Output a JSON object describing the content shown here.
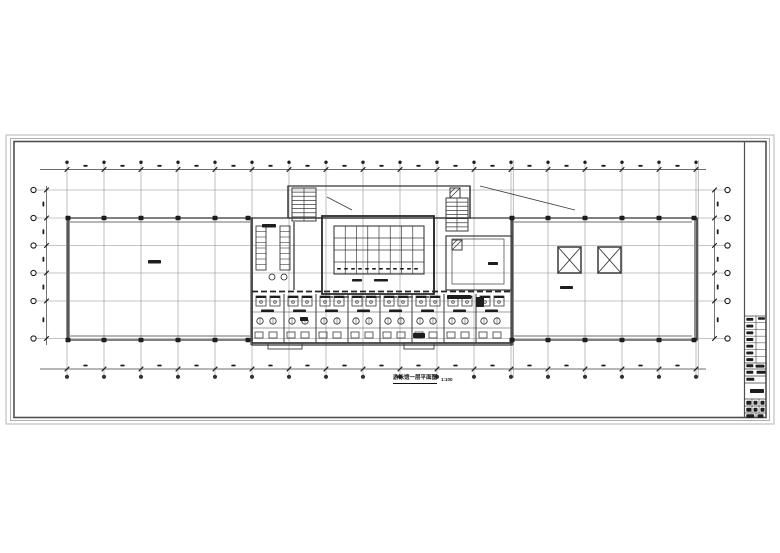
{
  "drawing": {
    "title": "游泳馆一层平面图",
    "scale": "1:100"
  },
  "colors": {
    "bg": "#ffffff",
    "line": "#3b3b3b",
    "dark": "#1d1d1d",
    "heavy": "#8f8f8f",
    "grid": "#8a8a8a",
    "frame_outer": "#b5b5b5",
    "frame_mid": "#9a9a9a",
    "frame_inner": "#4f4f4f"
  },
  "frame": {
    "outer": [
      6,
      135,
      768,
      289
    ],
    "mid": [
      10.5,
      138.5,
      759,
      282
    ],
    "inner": [
      14,
      141.5,
      752,
      276
    ],
    "divider_x": 744.5
  },
  "grid": {
    "verticals": {
      "x0": 67,
      "step": 37,
      "count": 18,
      "y1": 160,
      "y2": 378,
      "double_idx": [
        12,
        17
      ]
    },
    "horizontal_ys": [
      190,
      218,
      245.5,
      273,
      301,
      338.5
    ],
    "h_x1": 36,
    "h_x2": 726
  },
  "dims": {
    "top": {
      "y": 169.5,
      "x1": 40,
      "x2": 706,
      "bubble_y": 162.3
    },
    "bottom": {
      "y": 369,
      "x1": 40,
      "x2": 706,
      "bubble_y": 376.8
    },
    "left": {
      "x": 46.5,
      "y1": 186,
      "y2": 345,
      "bubble_x": 33.5,
      "text_x": 42.5
    },
    "right": {
      "x": 714.5,
      "y1": 190,
      "y2": 339,
      "bubble_x": 727.5,
      "text_x": 716.8
    }
  },
  "plan": {
    "outline_rects": [
      [
        68,
        218,
        184,
        122,
        1.3
      ],
      [
        512,
        218,
        185,
        122,
        1.3
      ],
      [
        288,
        186,
        182,
        32,
        1.3
      ],
      [
        252,
        218,
        260,
        127,
        1.3
      ],
      [
        446,
        236,
        66,
        54,
        1.2
      ],
      [
        452,
        239,
        52,
        45,
        0.7
      ],
      [
        268,
        343,
        34,
        6,
        0.9
      ],
      [
        404,
        343,
        30,
        6,
        0.9
      ]
    ],
    "inner_wall_lines": [
      [
        70,
        222,
        250,
        222,
        0.7
      ],
      [
        70,
        336,
        250,
        336,
        0.7
      ],
      [
        514,
        222,
        692,
        222,
        0.7
      ],
      [
        514,
        336,
        692,
        336,
        0.7
      ],
      [
        294,
        222,
        294,
        290,
        1.3
      ],
      [
        434,
        216,
        434,
        294,
        1.7
      ],
      [
        252,
        343,
        512,
        343,
        1.7
      ],
      [
        288,
        186,
        288,
        218,
        1.3
      ],
      [
        470,
        186,
        470,
        218,
        1.3
      ],
      [
        252,
        312,
        512,
        312,
        0.5
      ],
      [
        252,
        328,
        512,
        328,
        0.5
      ]
    ],
    "heavy_bars": [
      [
        66,
        218,
        4,
        122
      ],
      [
        694,
        218,
        4,
        122
      ],
      [
        510,
        218,
        4,
        127
      ],
      [
        250,
        218,
        3,
        127
      ]
    ],
    "pool": {
      "hall": [
        322,
        216,
        112,
        78
      ],
      "basin": [
        334,
        226,
        90,
        48
      ],
      "v_lanes": 7,
      "h_lines": [
        238,
        250,
        262
      ],
      "tick_y": 268,
      "ticks": 12
    },
    "shafts": [
      [
        558,
        247,
        23,
        26
      ],
      [
        598,
        247,
        23,
        26
      ]
    ],
    "hatch_squares": [
      [
        450,
        188,
        10,
        10
      ],
      [
        452,
        240,
        10,
        10
      ]
    ],
    "stairs": [
      {
        "x": 292,
        "y": 188,
        "w": 24,
        "h": 33,
        "steps": 8
      },
      {
        "x": 446,
        "y": 198,
        "w": 22,
        "h": 33,
        "steps": 8
      }
    ],
    "lockers": [
      {
        "x": 256,
        "y": 226,
        "w": 10,
        "h": 44,
        "cell": 5.5
      },
      {
        "x": 280,
        "y": 226,
        "w": 10,
        "h": 44,
        "cell": 5.5
      }
    ],
    "locker_circles": [
      [
        272,
        277,
        3
      ],
      [
        284,
        277,
        3
      ]
    ],
    "partitions_x": [
      284,
      316,
      348,
      380,
      412,
      444,
      476
    ],
    "partition_y1": 294,
    "partition_y2": 343,
    "dashed": [
      [
        252,
        291.5,
        512,
        291.5,
        1.8,
        "6 3"
      ],
      [
        328,
        297,
        432,
        297,
        1.2,
        "5 3"
      ]
    ],
    "bays_x": [
      252,
      284,
      316,
      348,
      380,
      412,
      444,
      476
    ],
    "bay": {
      "stall_y": 296,
      "stall_w": 10,
      "stall_h": 10,
      "circle_y": 321,
      "circle_r": 3.2,
      "low_y": 332,
      "low_w": 8,
      "low_h": 6,
      "mid_bar_y": 309.5
    },
    "extra_bars": [
      [
        447,
        295,
        24,
        4
      ],
      [
        476,
        297,
        8,
        10
      ],
      [
        300,
        317,
        8,
        4
      ],
      [
        413,
        333,
        12,
        5
      ]
    ],
    "column_xs_left": [
      68,
      104,
      141,
      178,
      215,
      248
    ],
    "column_xs_right": [
      512,
      548,
      585,
      622,
      659,
      694
    ],
    "column_ys": [
      215.7,
      337.7
    ],
    "leaders": [
      [
        327,
        197,
        352,
        210
      ],
      [
        480,
        186,
        575,
        210
      ]
    ],
    "labels": [
      [
        148,
        260,
        13,
        3.5
      ],
      [
        560,
        286,
        13,
        3
      ],
      [
        262,
        224,
        14,
        3.5
      ],
      [
        488,
        262,
        10,
        3
      ],
      [
        352,
        279,
        10,
        2.5
      ],
      [
        374,
        279,
        14,
        2.5
      ]
    ]
  },
  "titleblock": {
    "x1": 744.5,
    "x2": 766,
    "hlines": [
      316,
      363,
      369,
      376,
      383,
      399,
      406,
      413
    ],
    "sectA": {
      "y1": 316,
      "y2": 363,
      "rows": 7,
      "div_x": 756
    },
    "dividers": [
      [
        752,
        399,
        752,
        413
      ],
      [
        759,
        399,
        759,
        413
      ],
      [
        756,
        413,
        756,
        418
      ]
    ],
    "bars": [
      [
        758,
        317.2,
        7,
        2.5
      ],
      [
        746.3,
        364.3,
        7,
        3
      ],
      [
        755.5,
        364.6,
        9,
        3
      ],
      [
        746.3,
        370.8,
        7,
        3
      ],
      [
        756.5,
        370.8,
        9,
        3
      ],
      [
        746.3,
        377.8,
        8,
        3
      ],
      [
        750,
        389,
        14,
        4
      ],
      [
        746.3,
        400.7,
        5,
        4
      ],
      [
        753.5,
        400.7,
        4,
        4
      ],
      [
        760.5,
        400.7,
        4,
        4
      ],
      [
        746.3,
        407.7,
        5,
        4
      ],
      [
        753.5,
        407.7,
        4,
        4
      ],
      [
        760.5,
        407.7,
        4,
        4
      ],
      [
        746.3,
        414.3,
        8,
        3.5
      ],
      [
        757.5,
        414.3,
        6,
        3.5
      ]
    ]
  }
}
